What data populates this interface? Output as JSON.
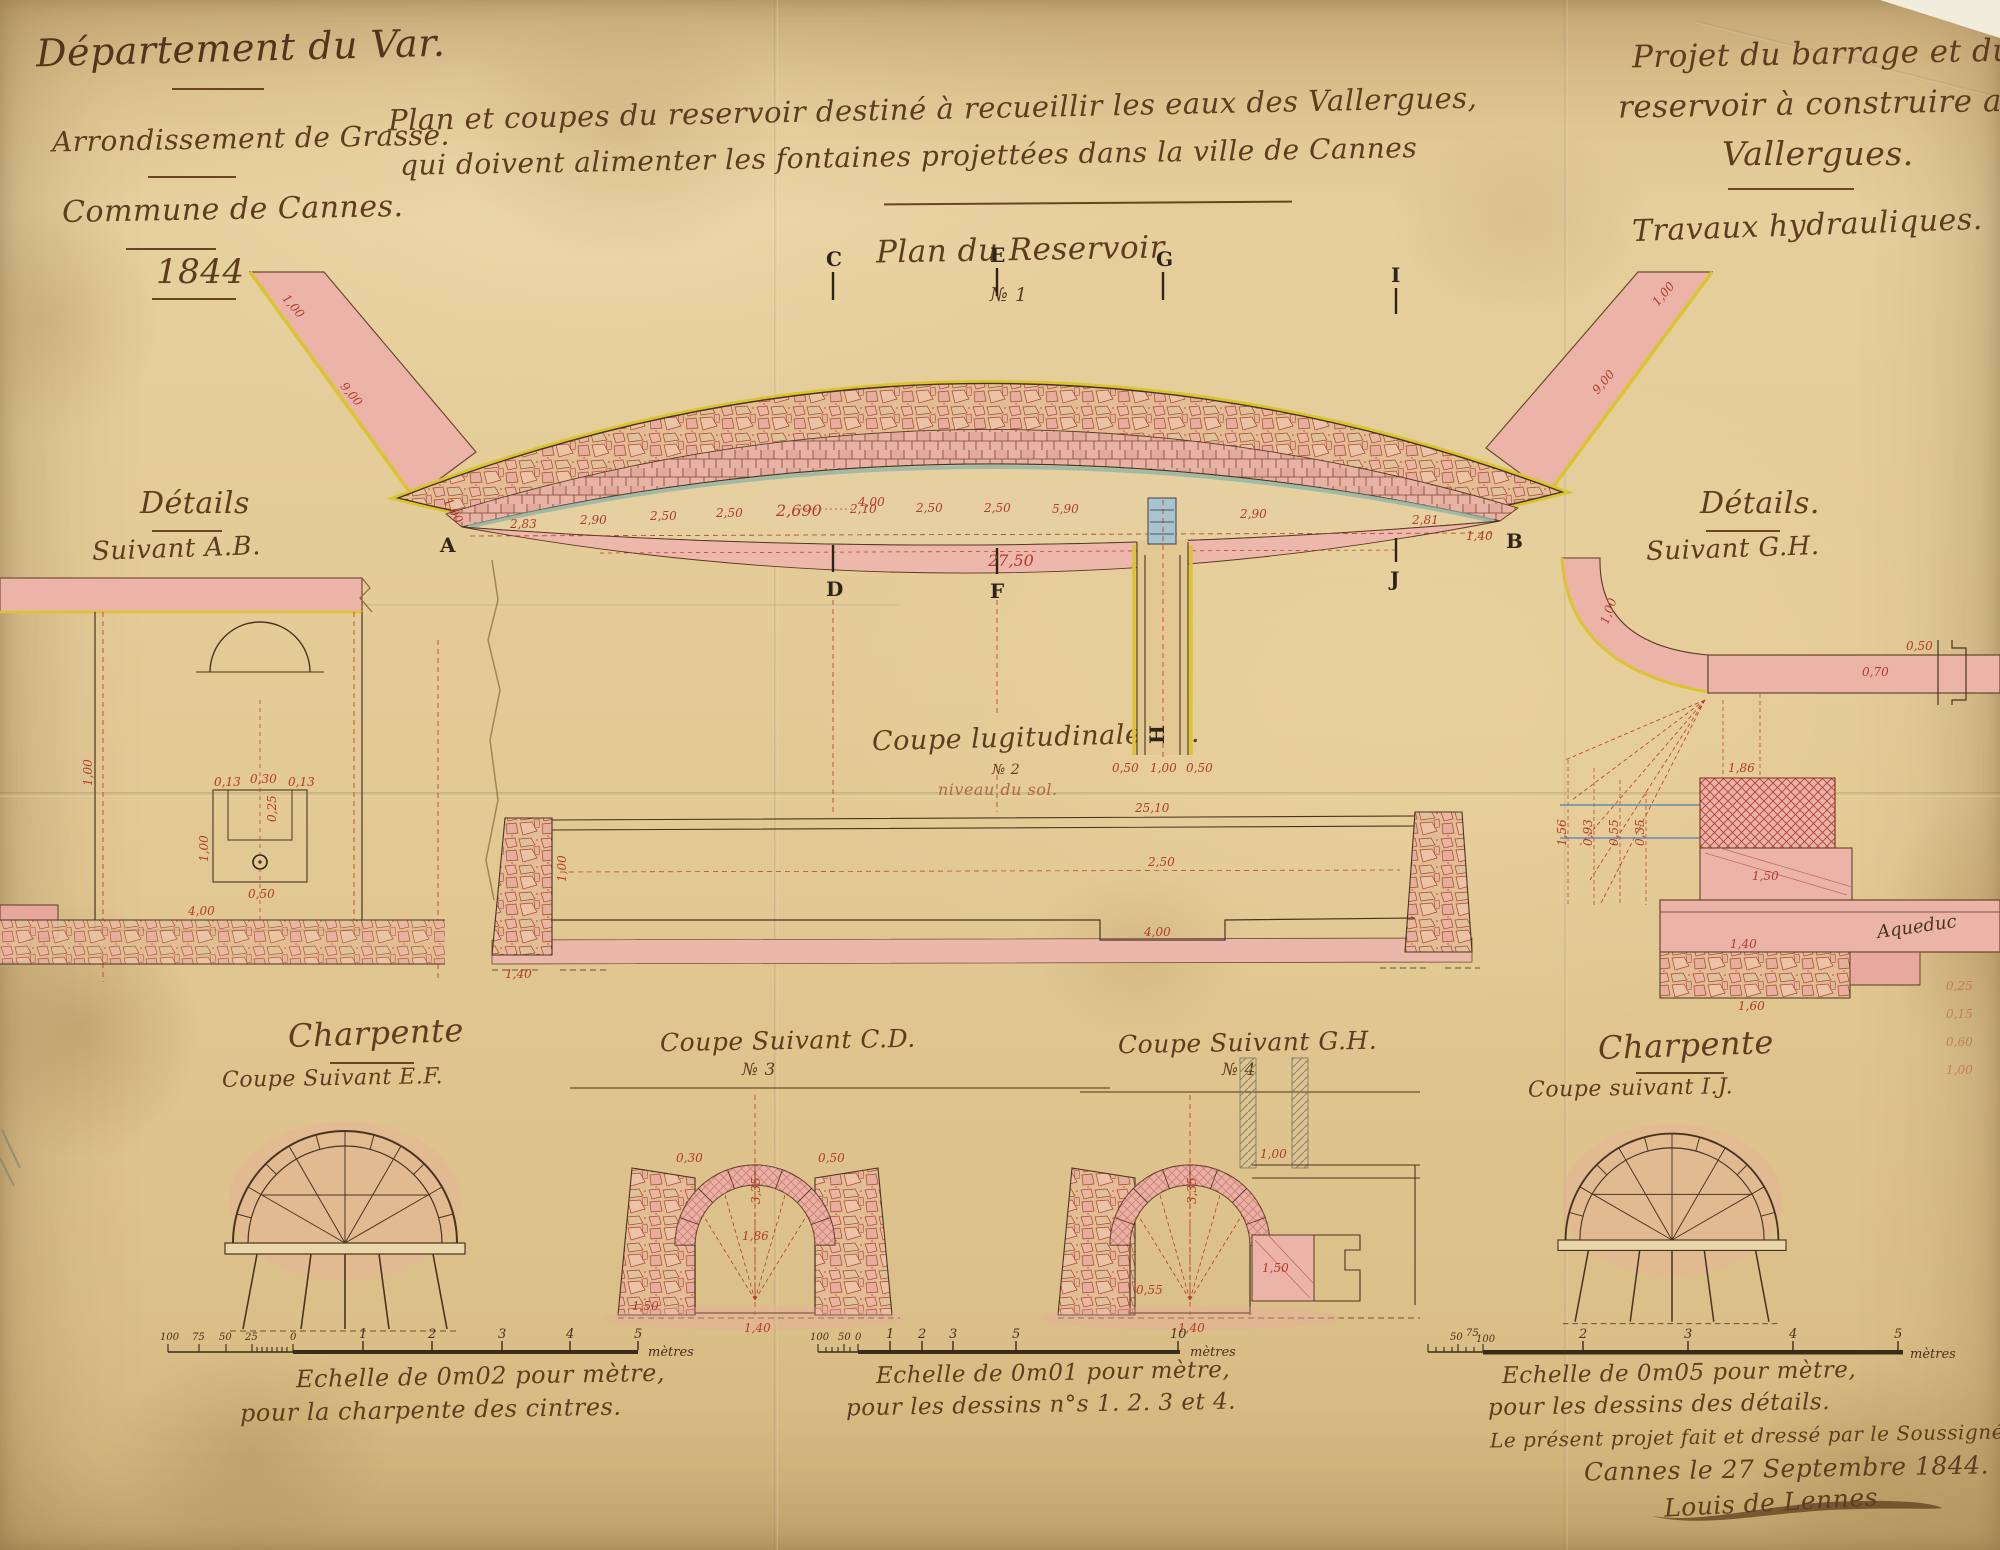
{
  "page": {
    "header_left": {
      "department": "Département du Var.",
      "arrondissement": "Arrondissement de Grasse.",
      "commune": "Commune de Cannes.",
      "year": "1844"
    },
    "title": {
      "line1": "Plan et coupes du reservoir destiné à recueillir les eaux des Vallergues,",
      "line2": "qui doivent alimenter les fontaines projettées dans la ville de Cannes"
    },
    "header_right": {
      "line1": "Projet du barrage et du",
      "line2": "reservoir à construire aux",
      "line3": "Vallergues.",
      "works": "Travaux hydrauliques."
    }
  },
  "plan": {
    "title": "Plan du Reservoir",
    "number": "№ 1",
    "letters": {
      "A": "A",
      "B": "B",
      "C": "C",
      "D": "D",
      "E": "E",
      "F": "F",
      "G": "G",
      "H": "H",
      "I": "I",
      "J": "J"
    },
    "dims_row": [
      "2,83",
      "2,90",
      "2,50",
      "2,50",
      "2,690",
      "2,10",
      "2,50",
      "2,50",
      "5,90",
      "2,90",
      "2,81"
    ],
    "dim_4": "4,00",
    "dim_2750": "27,50",
    "wing_left_tip": "1,00",
    "wing_left_len": "9,00",
    "wing_right_len": "9,00",
    "wing_right_tip": "1,00",
    "dim_a": "1,00",
    "dim_b": "1,40",
    "outlet_dims": [
      "0,50",
      "1,00",
      "0,50"
    ]
  },
  "detail_left": {
    "title": "Détails",
    "subtitle": "Suivant A.B.",
    "dims": {
      "a": "0,13",
      "b": "0,30",
      "c": "0,13",
      "d": "0,25",
      "e": "1,00",
      "f": "0,50",
      "g": "4,00",
      "h": "1,00"
    }
  },
  "detail_right": {
    "title": "Détails.",
    "subtitle": "Suivant G.H.",
    "aqueduc": "Aqueduc",
    "dims": {
      "a": "0,50",
      "b": "0,70",
      "c": "1,00",
      "d": "1,86",
      "e": "1,56",
      "f": "0,93",
      "g": "0,55",
      "h": "0,35",
      "i": "1,50",
      "j": "1,40",
      "k": "1,60"
    },
    "margin_figures": [
      "0,25",
      "0,15",
      "0,60",
      "1,00"
    ]
  },
  "long_section": {
    "title": "Coupe lugitudinale AB.",
    "number": "№ 2",
    "ground": "niveau du sol.",
    "dims": {
      "top": "25,10",
      "mid": "2,50",
      "sump": "4,00",
      "left": "1,00",
      "bottom": "1,40"
    }
  },
  "sections": {
    "ef": {
      "title": "Charpente",
      "subtitle": "Coupe Suivant E.F."
    },
    "cd": {
      "title": "Coupe Suivant C.D.",
      "number": "№ 3",
      "dims": {
        "a": "3,35",
        "b": "1,86",
        "c": "0,50",
        "d": "0,30",
        "e": "1,50",
        "f": "1,40"
      }
    },
    "gh": {
      "title": "Coupe Suivant G.H.",
      "number": "№ 4",
      "dims": {
        "a": "1,00",
        "b": "3,35",
        "c": "1,50",
        "d": "1,40",
        "e": "0,55"
      }
    },
    "ij": {
      "title": "Charpente",
      "subtitle": "Coupe suivant I.J."
    }
  },
  "scales": {
    "left": {
      "caption1": "Echelle de 0m02 pour mètre,",
      "caption2": "pour la charpente des cintres.",
      "sub": [
        "100",
        "75",
        "50",
        "25",
        "0"
      ],
      "main": [
        "1",
        "2",
        "3",
        "4",
        "5"
      ],
      "unit": "mètres"
    },
    "center": {
      "caption1": "Echelle de 0m01 pour mètre,",
      "caption2": "pour les dessins n°s 1. 2. 3 et 4.",
      "sub": [
        "100",
        "50",
        "0"
      ],
      "main": [
        "1",
        "2",
        "3",
        "5",
        "10"
      ],
      "unit": "mètres"
    },
    "right": {
      "caption1": "Echelle de 0m05 pour mètre,",
      "caption2": "pour les dessins des détails.",
      "sub": [
        "50",
        "75",
        "100"
      ],
      "main": [
        "2",
        "3",
        "4",
        "5"
      ],
      "unit": "mètres"
    }
  },
  "signature": {
    "line1": "Le présent projet fait et dressé par le Soussigné",
    "line2": "Cannes le 27 Septembre 1844.",
    "name": "Louis de Lennes"
  },
  "colors": {
    "ink": "#5e3c1e",
    "red": "#b23b2a",
    "pink": "#ecb4a9",
    "yellow": "#d9c531",
    "blue": "#7fa8b8",
    "paper": "#e3c894"
  }
}
